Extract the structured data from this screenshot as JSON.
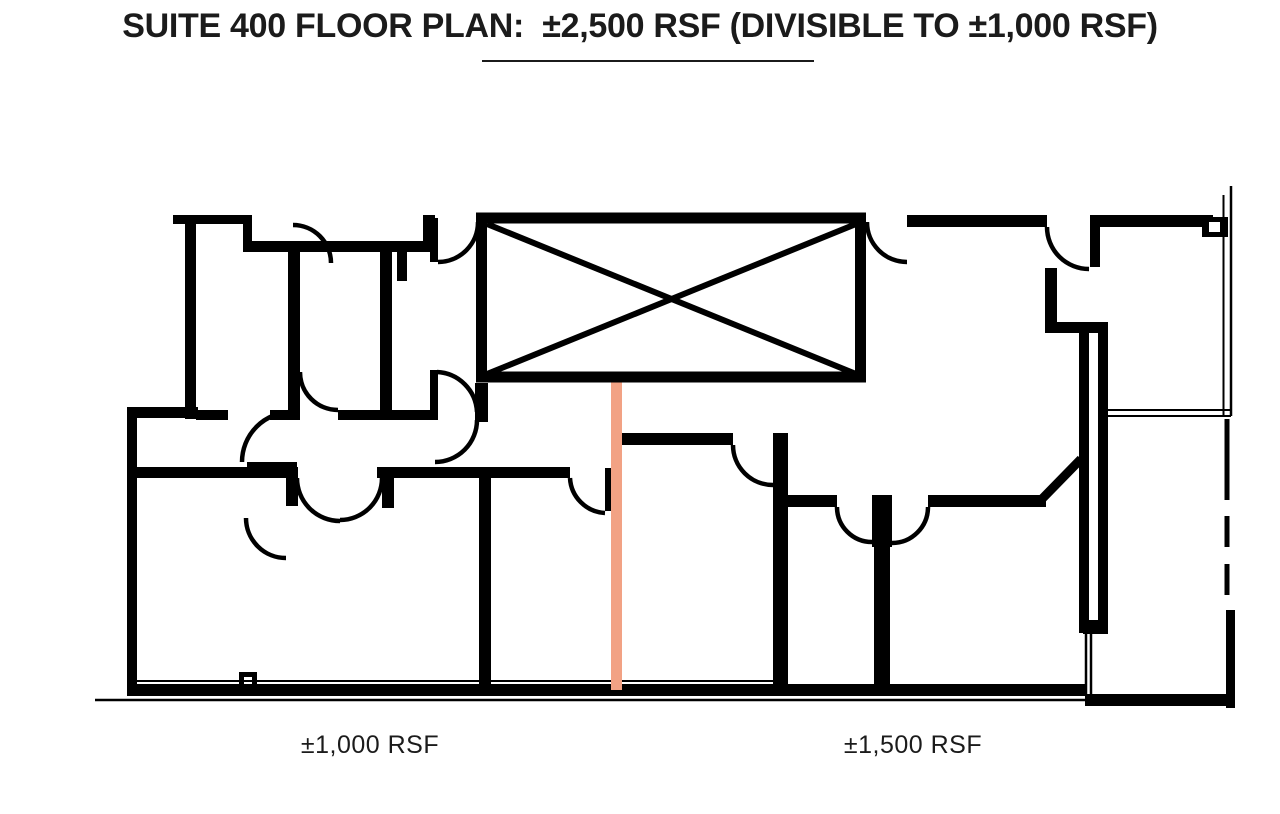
{
  "title": {
    "text": "SUITE 400 FLOOR PLAN:  ±2,500 RSF (DIVISIBLE TO ±1,000 RSF)"
  },
  "plan": {
    "colors": {
      "wall": "#000000",
      "demising_line": "#F2A284",
      "background": "#FFFFFF"
    },
    "areas": [
      {
        "label": "±1,000 RSF"
      },
      {
        "label": "±1,500 RSF"
      }
    ]
  }
}
